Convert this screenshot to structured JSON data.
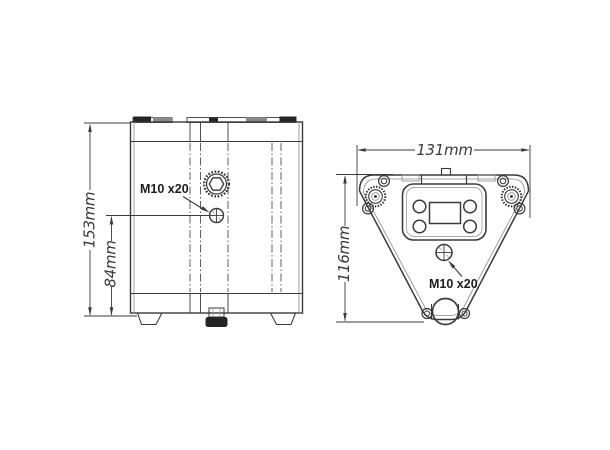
{
  "drawing": {
    "kind": "two-view technical drawing of a triangular motor/pump unit",
    "background": "#ffffff",
    "line_color": "#3a3a3a",
    "dark_fill": "#242424"
  },
  "side_view": {
    "name": "front elevation",
    "label_total_height": "153mm",
    "label_bolt_height": "84mm",
    "label_bolt": "M10 x20"
  },
  "top_view": {
    "name": "top plan view",
    "label_width": "131mm",
    "label_depth": "116mm",
    "label_bolt": "M10 x20"
  }
}
